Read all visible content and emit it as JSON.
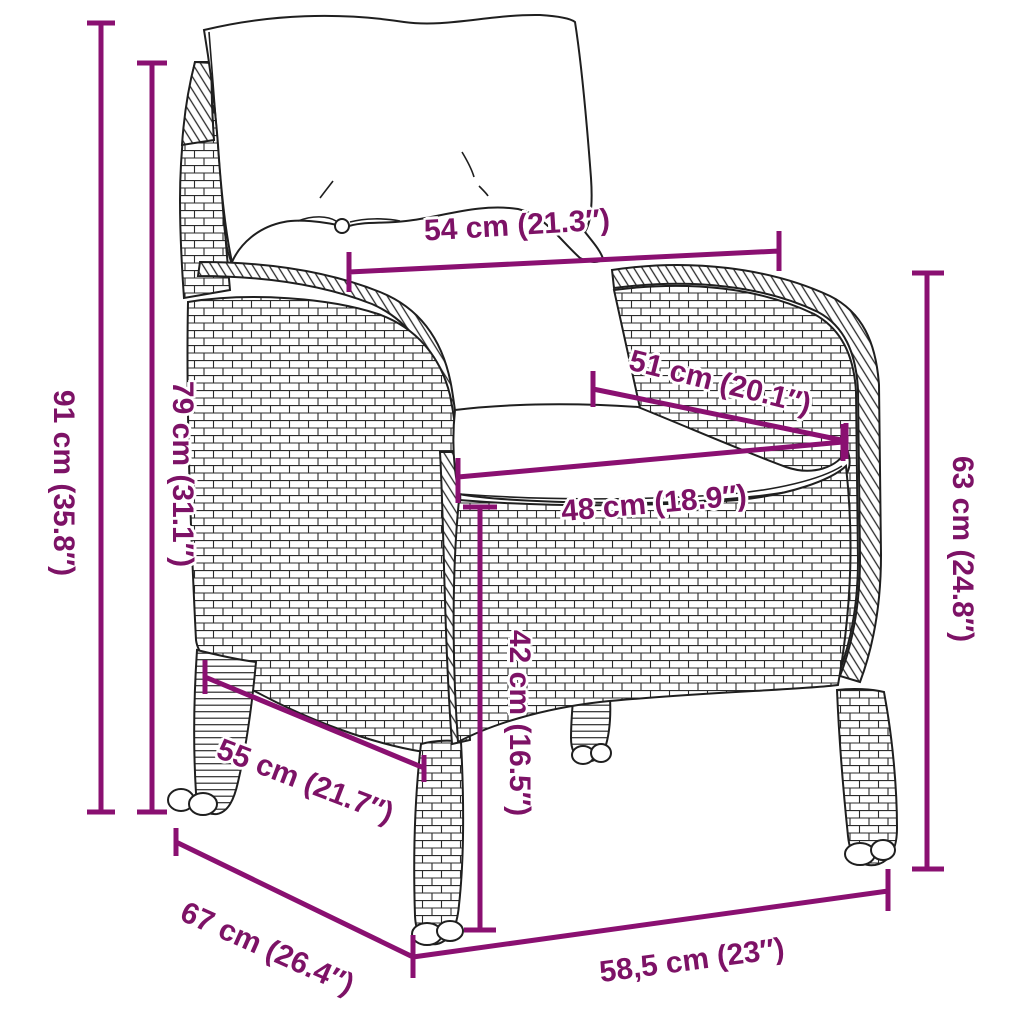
{
  "colors": {
    "accent_line": "#8a1071",
    "accent_text": "#7d1266",
    "drawing_ink": "#1f1f1f",
    "background": "#ffffff"
  },
  "dimensions": {
    "total_height": {
      "label": "91 cm (35.8″)"
    },
    "back_height": {
      "label": "79 cm (31.1″)"
    },
    "back_width": {
      "label": "54 cm (21.3″)"
    },
    "seat_depth": {
      "label": "51 cm (20.1″)"
    },
    "seat_width": {
      "label": "48 cm (18.9″)"
    },
    "seat_height": {
      "label": "42 cm (16.5″)"
    },
    "armrest_height": {
      "label": "63 cm (24.8″)"
    },
    "leg_span_side": {
      "label": "55 cm (21.7″)"
    },
    "total_depth": {
      "label": "67 cm (26.4″)"
    },
    "front_width": {
      "label": "58,5 cm (23″)"
    }
  }
}
